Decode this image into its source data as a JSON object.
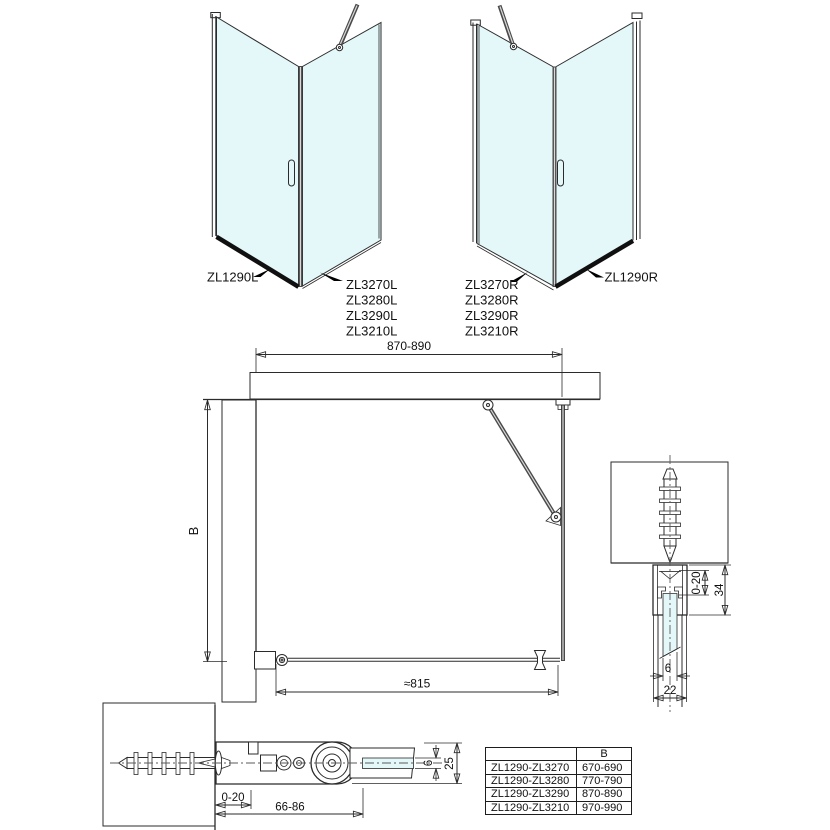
{
  "iso_left": {
    "side_label": "ZL1290L",
    "door_labels": [
      "ZL3270L",
      "ZL3280L",
      "ZL3290L",
      "ZL3210L"
    ]
  },
  "iso_right": {
    "door_labels": [
      "ZL3270R",
      "ZL3280R",
      "ZL3290R",
      "ZL3210R"
    ],
    "side_label": "ZL1290R"
  },
  "plan": {
    "width_dim": "870-890",
    "depth_dim": "B",
    "opening_dim": "≈815"
  },
  "wall_section": {
    "adjust_dim": "0-20",
    "depth_dim": "34",
    "glass_dim": "6",
    "width_dim": "22"
  },
  "bracket_section": {
    "adjust_dim": "0-20",
    "range_dim": "66-86",
    "glass_dim": "6",
    "height_dim": "25"
  },
  "table": {
    "header_model": "",
    "header_b": "B",
    "rows": [
      {
        "model": "ZL1290-ZL3270",
        "b": "670-690"
      },
      {
        "model": "ZL1290-ZL3280",
        "b": "770-790"
      },
      {
        "model": "ZL1290-ZL3290",
        "b": "870-890"
      },
      {
        "model": "ZL1290-ZL3210",
        "b": "970-990"
      }
    ]
  },
  "colors": {
    "glass": "#e4f7f9",
    "line": "#2b2b2b",
    "hatch": "#4a4a4a"
  }
}
